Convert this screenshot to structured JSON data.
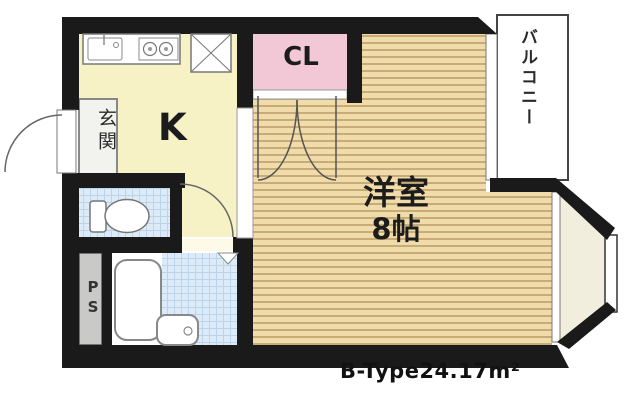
{
  "plan": {
    "rooms": {
      "kitchen": {
        "label": "K"
      },
      "closet": {
        "label": "CL"
      },
      "western_room": {
        "label": "洋室",
        "size": "8帖"
      },
      "entrance": {
        "label": "玄関"
      },
      "balcony": {
        "label": "バルコニー"
      },
      "pipe_space": {
        "label": "PS"
      }
    },
    "footer": {
      "label": "B-Type24.17m²"
    },
    "colors": {
      "wall": "#1a1a1a",
      "kitchen_fill": "#f6f2c6",
      "closet_fill": "#f2c8d6",
      "flooring_fill": "#efdcaa",
      "flooring_line": "#c9ab78",
      "tile_fill": "#dcebf7",
      "tile_line": "#bcd4ea",
      "pipe_space_fill": "#c9c9c7",
      "bay_floor_fill": "#f2eedd"
    }
  }
}
